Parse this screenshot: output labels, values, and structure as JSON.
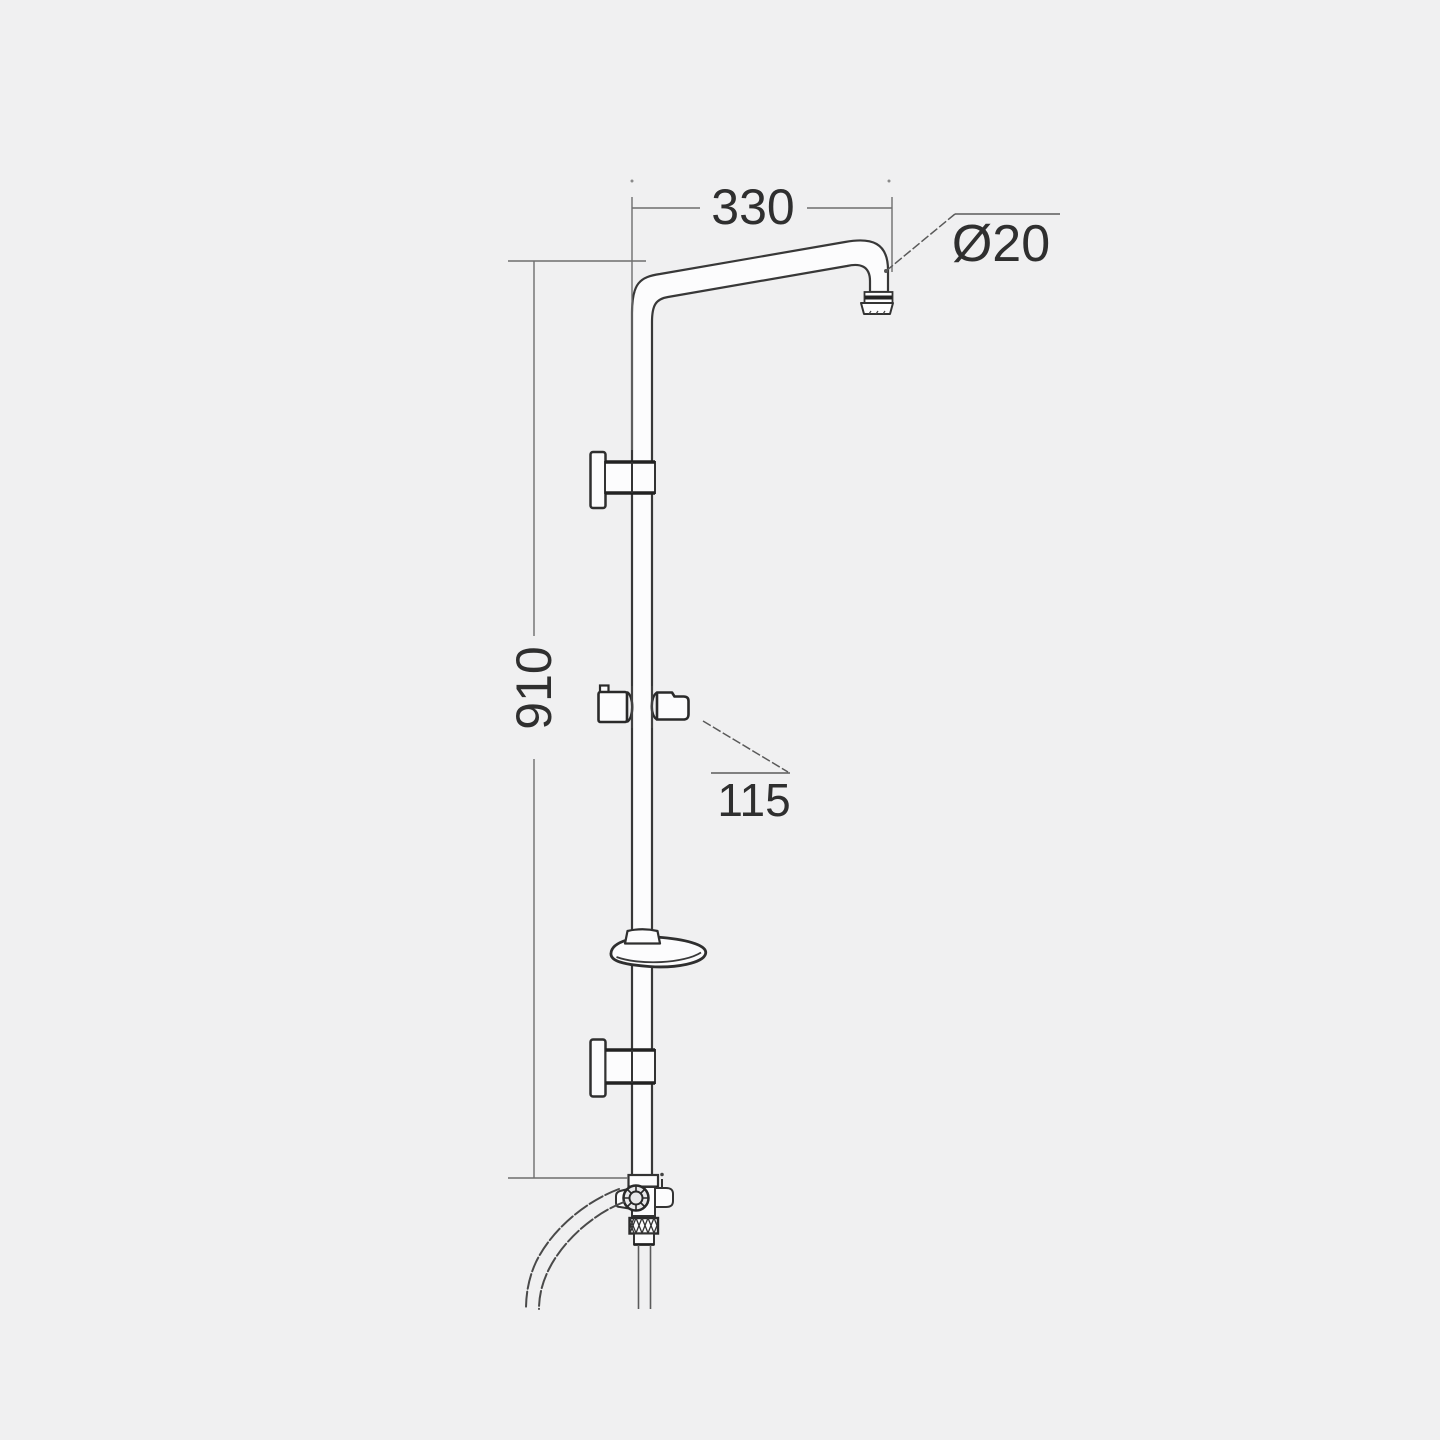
{
  "page": {
    "background": "#f0f0f1",
    "description": "Technical dimension drawing of a wall-mounted shower column with swan-neck arm, riser rail, sliding handset holder, soap dish, wall brackets and flexible hose"
  },
  "drawing": {
    "stroke_color": "#383838",
    "dimension_line_color": "#6e6e6e",
    "leader_line_color": "#5a5a5a",
    "text_color": "#2f2f2f",
    "tube_fill_color": "#fcfcfd"
  },
  "dims": {
    "arm_reach": {
      "label": "330",
      "value": 330,
      "unit": "mm",
      "measures": "horizontal reach of top shower arm"
    },
    "outlet_diameter": {
      "label": "Ø20",
      "value": 20,
      "unit": "mm",
      "measures": "diameter of shower-arm outlet pipe"
    },
    "rail_height": {
      "label": "910",
      "value": 910,
      "unit": "mm",
      "measures": "vertical height of riser rail"
    },
    "holder_projection": {
      "label": "115",
      "value": 115,
      "unit": "mm",
      "measures": "sliding handset holder dimension"
    }
  },
  "components": {
    "shower_arm": "swan-neck shower arm",
    "arm_outlet": "arm outlet fitting",
    "riser_rail": "riser rail",
    "upper_wall_bracket": "upper wall bracket",
    "slider_holder": "sliding handset holder",
    "soap_dish": "soap dish",
    "lower_wall_bracket": "lower wall bracket",
    "diverter_assembly": "hose connector / diverter body",
    "shower_hose": "flexible shower hose",
    "down_pipe": "lower supply pipe"
  }
}
